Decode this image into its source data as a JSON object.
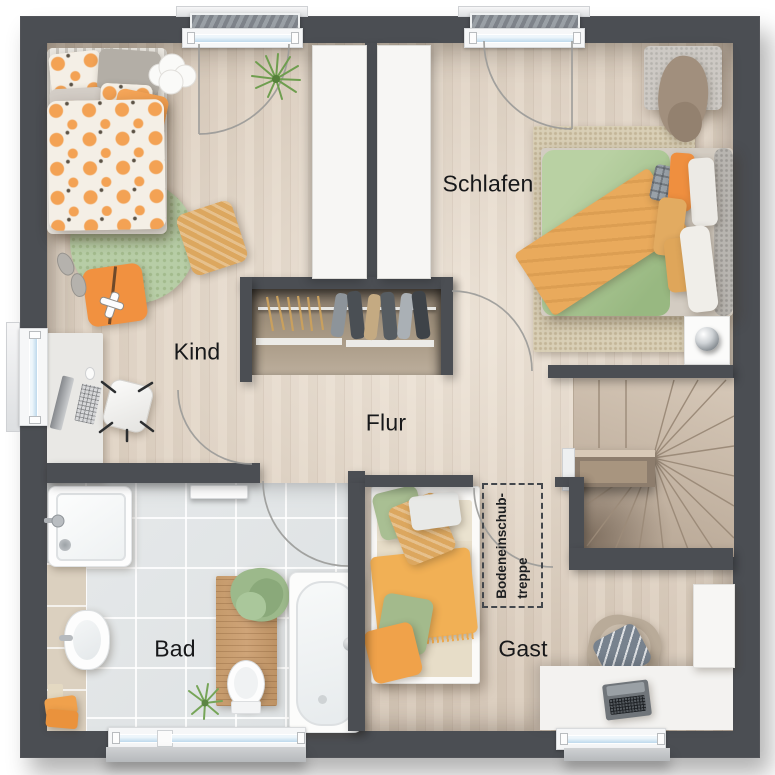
{
  "floorplan": {
    "rooms": [
      {
        "id": "kind",
        "label": "Kind"
      },
      {
        "id": "schlafen",
        "label": "Schlafen"
      },
      {
        "id": "flur",
        "label": "Flur"
      },
      {
        "id": "bad",
        "label": "Bad"
      },
      {
        "id": "gast",
        "label": "Gast"
      }
    ],
    "annotations": {
      "attic_stair": {
        "line1": "Bodeneinschub-",
        "line2": "treppe"
      }
    },
    "colors": {
      "wall": "#4b4e53",
      "wood_floor": "#d8cabb",
      "tile_floor": "#e2e5e7",
      "closet_niche": "#a3927f",
      "stair_wood": "#c9baa9",
      "window_glass": "#c7dff0",
      "rug_green": "#b7cda6",
      "rug_beige": "#d9cfb6",
      "accent_orange": "#f0a052",
      "accent_green": "#a9c495"
    }
  }
}
